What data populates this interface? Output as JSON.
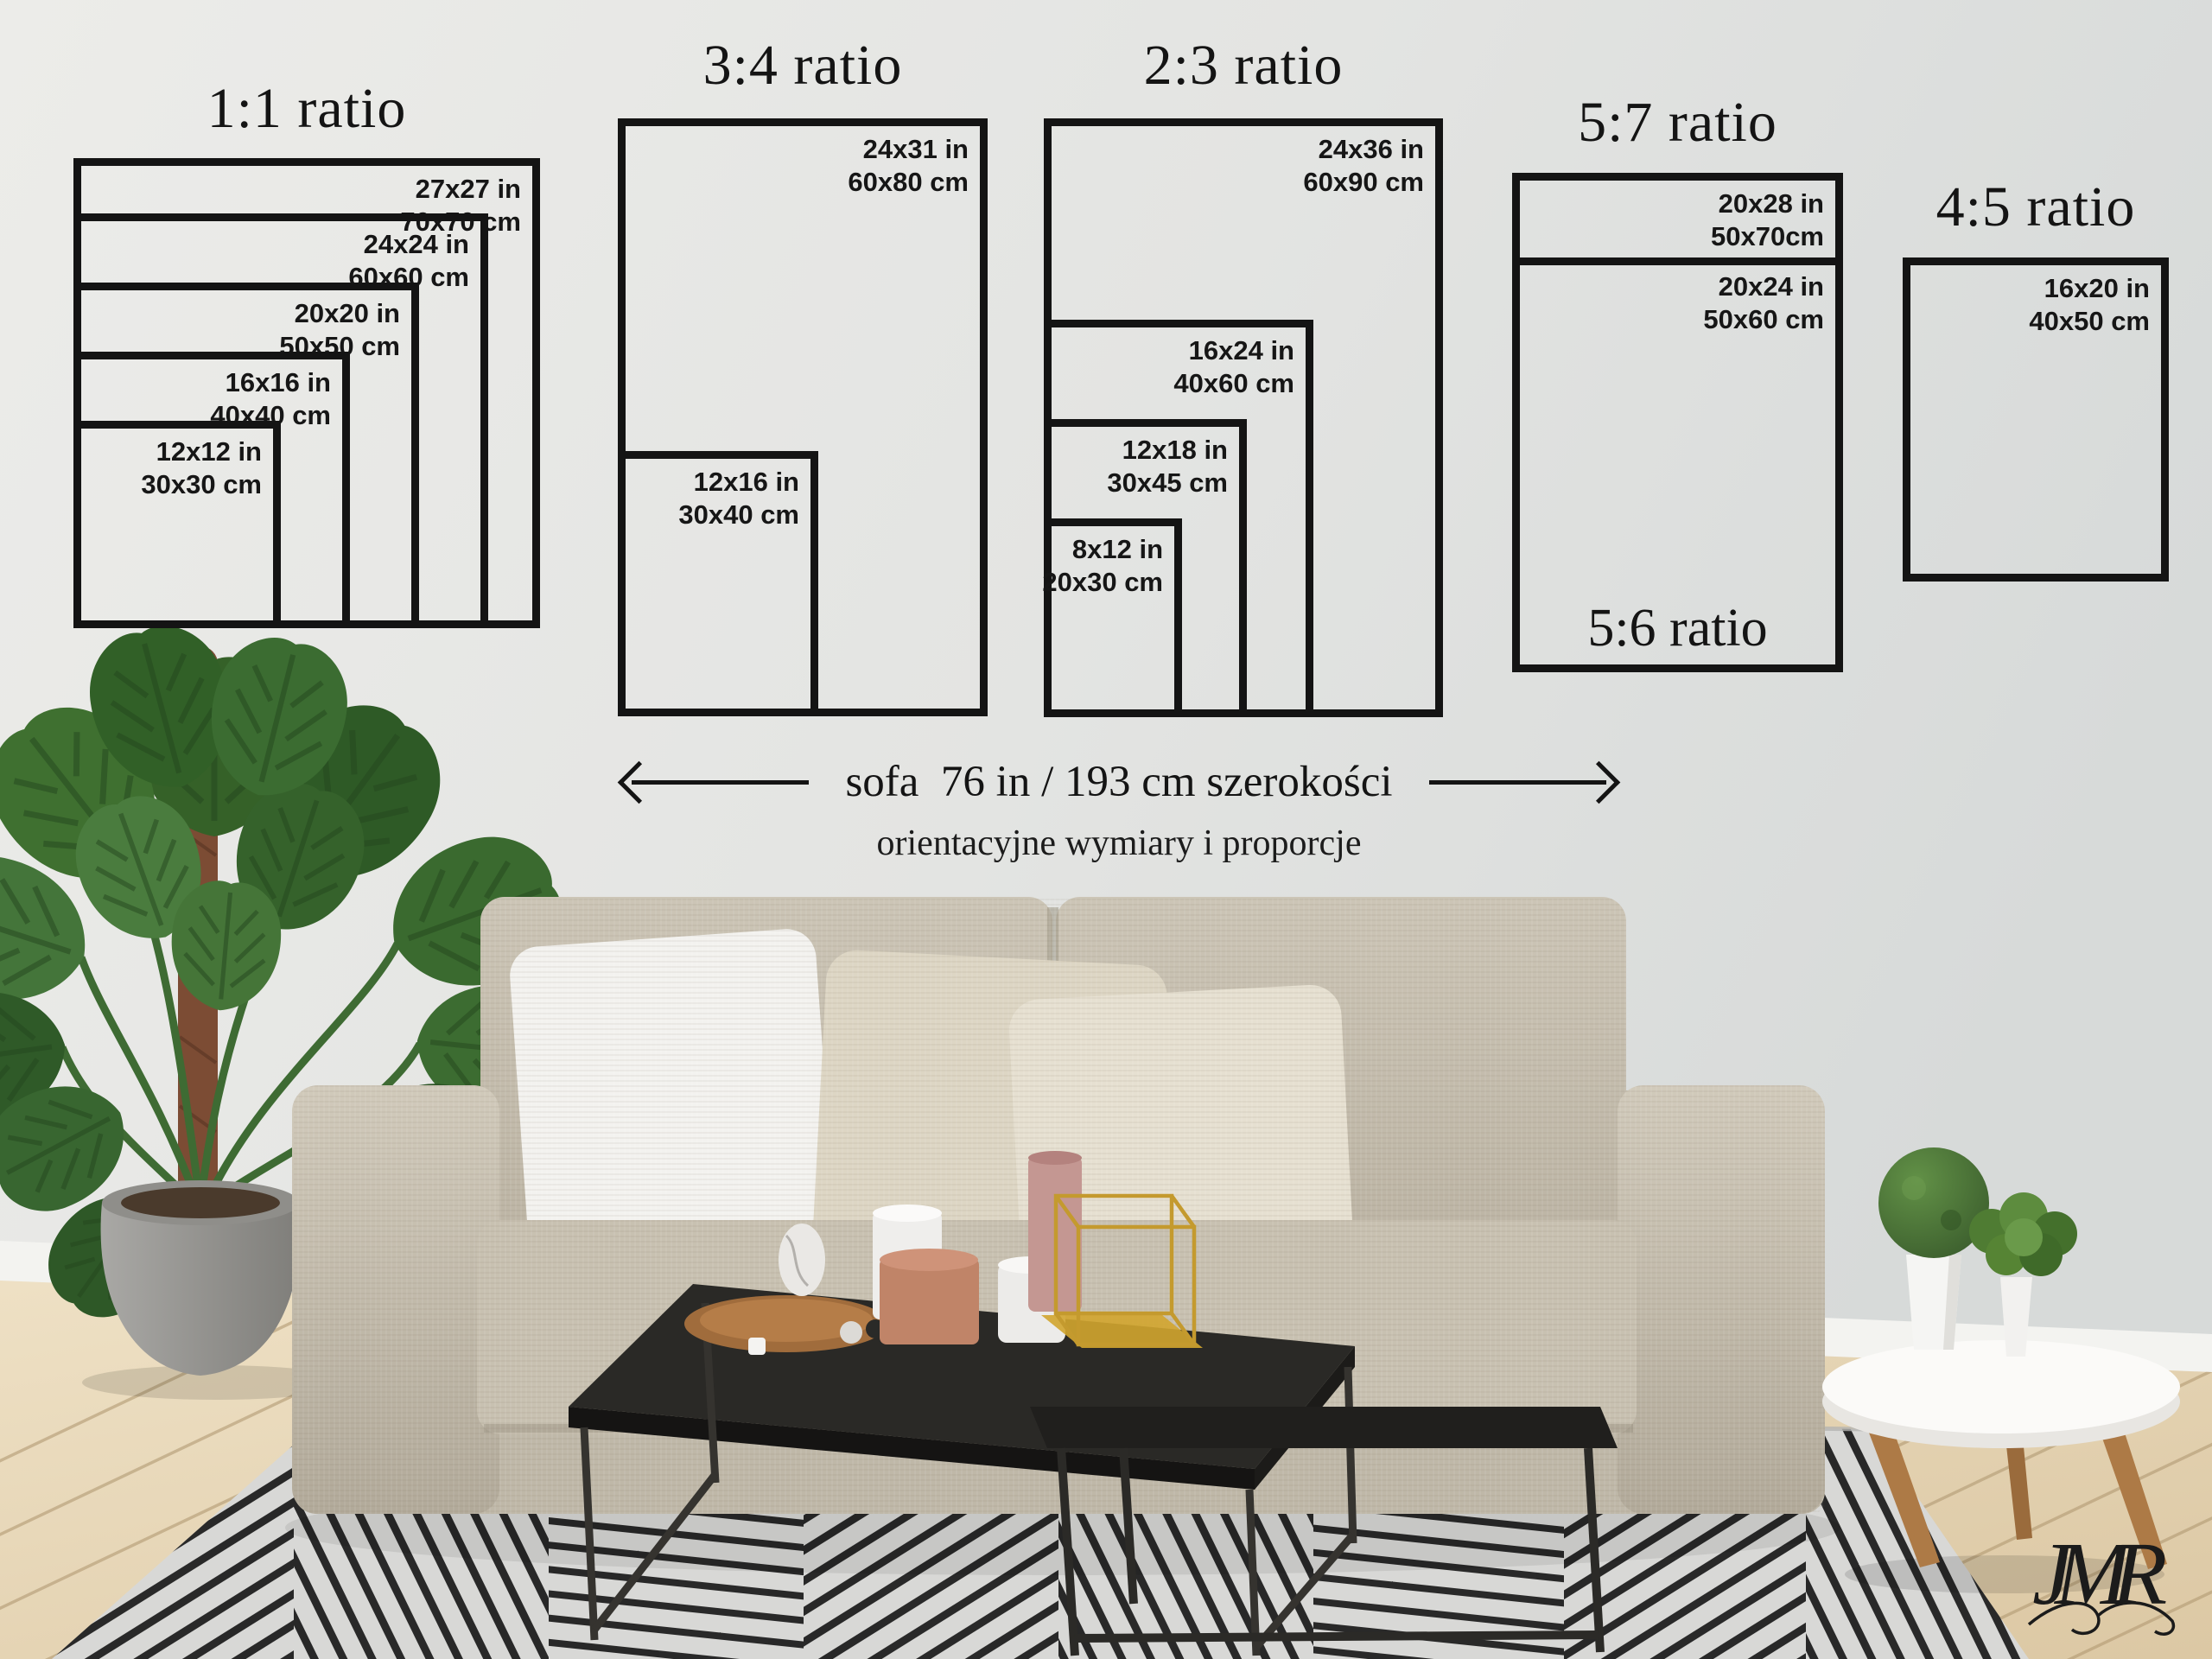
{
  "diagram": {
    "groups": [
      {
        "title": "1:1 ratio",
        "frames": [
          {
            "in": "27x27 in",
            "cm": "70x70 cm"
          },
          {
            "in": "24x24 in",
            "cm": "60x60 cm"
          },
          {
            "in": "20x20 in",
            "cm": "50x50 cm"
          },
          {
            "in": "16x16 in",
            "cm": "40x40 cm"
          },
          {
            "in": "12x12 in",
            "cm": "30x30 cm"
          }
        ]
      },
      {
        "title": "3:4 ratio",
        "frames": [
          {
            "in": "24x31 in",
            "cm": "60x80 cm"
          },
          {
            "in": "12x16 in",
            "cm": "30x40 cm"
          }
        ]
      },
      {
        "title": "2:3 ratio",
        "frames": [
          {
            "in": "24x36 in",
            "cm": "60x90 cm"
          },
          {
            "in": "16x24 in",
            "cm": "40x60 cm"
          },
          {
            "in": "12x18 in",
            "cm": "30x45 cm"
          },
          {
            "in": "8x12 in",
            "cm": "20x30 cm"
          }
        ]
      },
      {
        "title": "5:7 ratio",
        "secondary_title": "5:6 ratio",
        "frames": [
          {
            "in": "20x28 in",
            "cm": "50x70cm"
          },
          {
            "in": "20x24 in",
            "cm": "50x60 cm"
          }
        ]
      },
      {
        "title": "4:5 ratio",
        "frames": [
          {
            "in": "16x20 in",
            "cm": "40x50 cm"
          }
        ]
      }
    ],
    "sofa_note": "sofa  76 in / 193 cm szerokości",
    "subtitle": "orientacyjne wymiary i proporcje"
  },
  "watermark": "JMR",
  "colors": {
    "frame_line": "#141414",
    "wall": "#e6e7e5",
    "sofa_fabric": "#c3bcac",
    "pillow_white": "#f3f2ef",
    "pillow_beige": "#ddd6c4",
    "table_black": "#222120",
    "leg_wood": "#ad7a46",
    "floor_wood": "#e6d8ba",
    "rug_base": "#d8d8d6",
    "rug_stripe": "#161616",
    "plant_green": "#3a6a2f",
    "pot_gray": "#979693",
    "tray_wood": "#a5713f",
    "gold": "#c49a2e",
    "blush": "#c08468"
  }
}
